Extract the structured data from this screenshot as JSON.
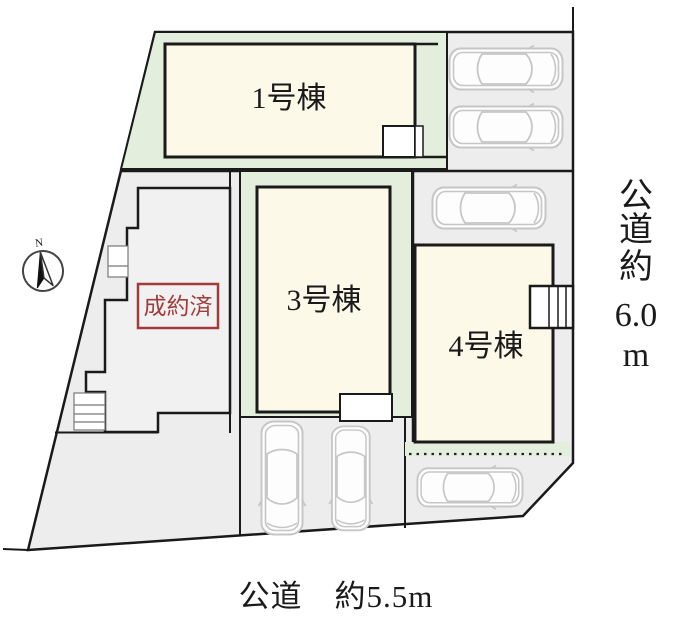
{
  "plan": {
    "units": {
      "unit1": {
        "label": "1号棟"
      },
      "unit3": {
        "label": "3号棟"
      },
      "unit4": {
        "label": "4号棟"
      },
      "sold": {
        "label": "成約済"
      }
    },
    "roads": {
      "right": {
        "lines": [
          "公",
          "道",
          "約",
          "6.0",
          "m"
        ],
        "full_text": "公道 約6.0m"
      },
      "bottom": {
        "text": "公道　約5.5m"
      }
    },
    "compass": {
      "label": "N"
    },
    "parking": {
      "car_count": 6
    },
    "colors": {
      "lot_green": "#e3efdc",
      "building_cream": "#fcf9e9",
      "ground_gray": "#ededed",
      "sold_building_gray": "#f1f1f1",
      "outline_black": "#1a1a1a",
      "sold_red": "#a33b3b",
      "car_outline": "#c6c6c6"
    }
  }
}
